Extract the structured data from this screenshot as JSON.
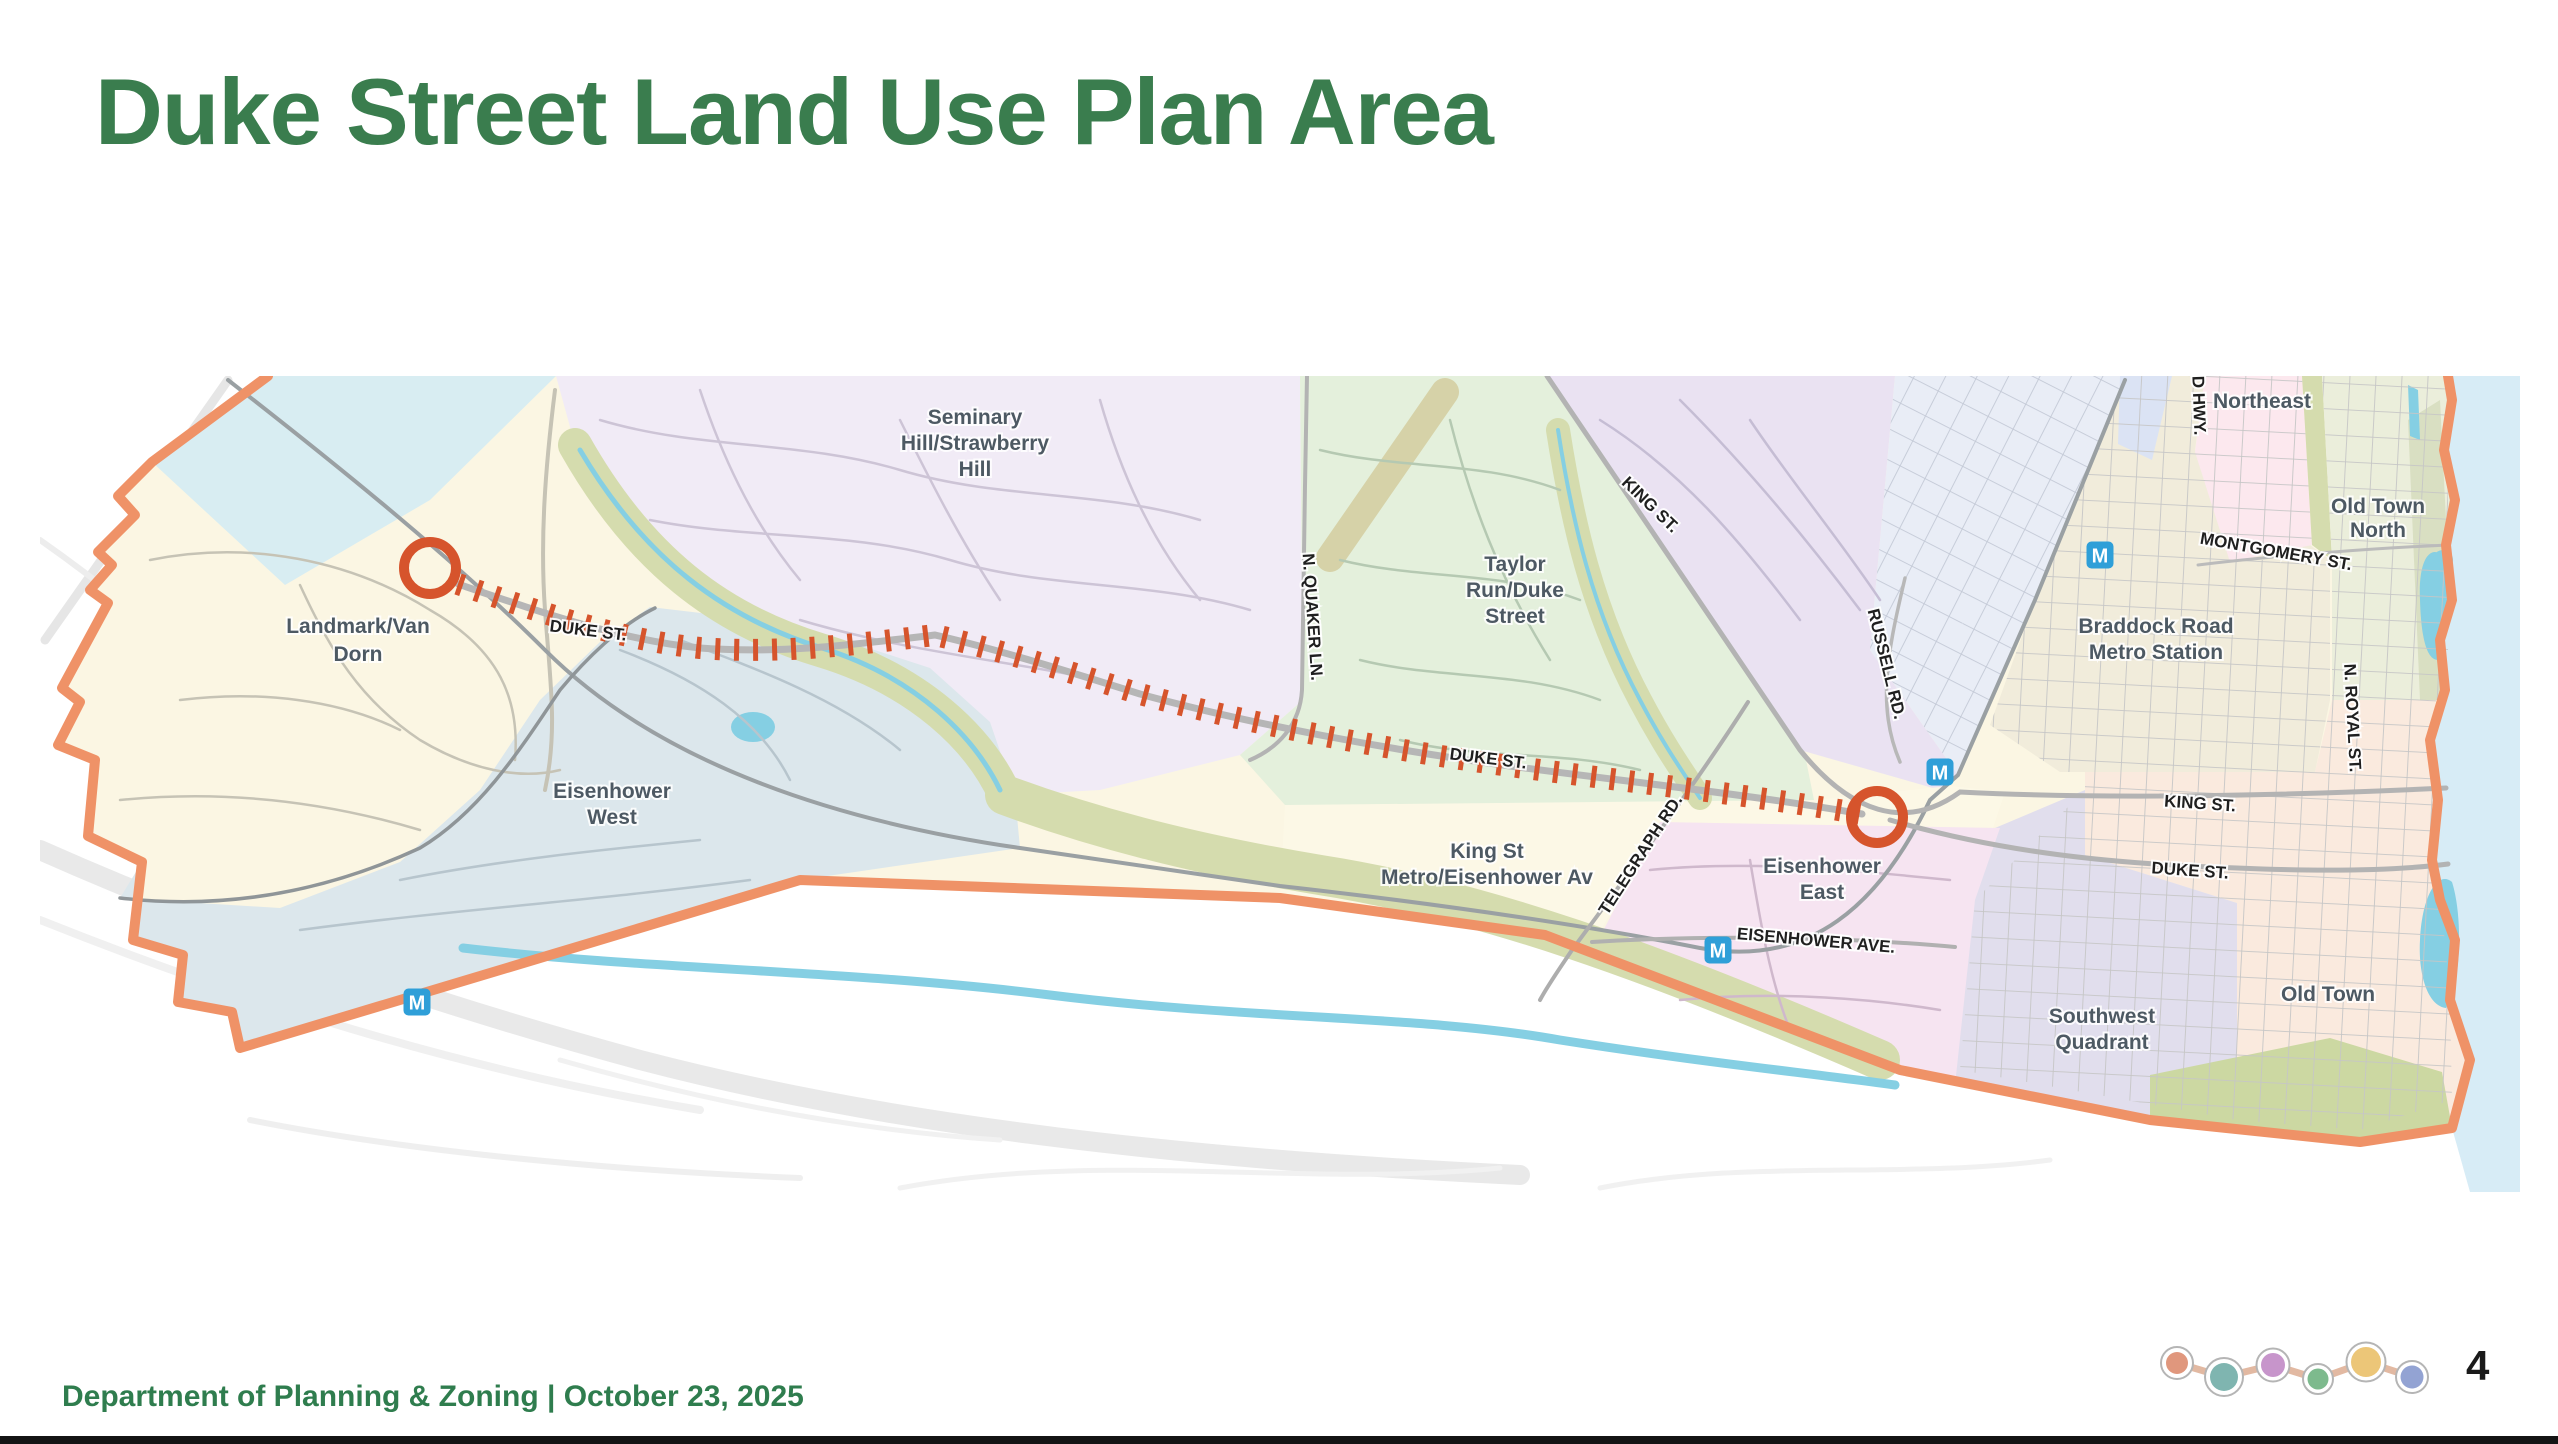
{
  "slide": {
    "title": "Duke Street Land Use Plan Area",
    "footer": "Department of Planning & Zoning  |  October 23, 2025",
    "page_number": "4"
  },
  "map": {
    "zone_labels": {
      "landmark_l1": "Landmark/Van",
      "landmark_l2": "Dorn",
      "eisenhower_west_l1": "Eisenhower",
      "eisenhower_west_l2": "West",
      "seminary_l1": "Seminary",
      "seminary_l2": "Hill/Strawberry",
      "seminary_l3": "Hill",
      "taylor_l1": "Taylor",
      "taylor_l2": "Run/Duke",
      "taylor_l3": "Street",
      "kingst_metro_l1": "King St",
      "kingst_metro_l2": "Metro/Eisenhower Av",
      "eisenhower_east_l1": "Eisenhower",
      "eisenhower_east_l2": "East",
      "braddock_l1": "Braddock Road",
      "braddock_l2": "Metro Station",
      "southwest_l1": "Southwest",
      "southwest_l2": "Quadrant",
      "old_town": "Old Town",
      "old_town_north_l1": "Old Town",
      "old_town_north_l2": "North",
      "northeast": "Northeast"
    },
    "street_labels": {
      "duke_west": "DUKE ST.",
      "duke_mid": "DUKE ST.",
      "duke_old_town": "DUKE ST.",
      "king_diag": "KING ST.",
      "king_old_town": "KING ST.",
      "quaker": "N. QUAKER LN.",
      "telegraph": "TELEGRAPH RD.",
      "russell": "RUSSELL RD.",
      "eisenhower_ave": "EISENHOWER AVE.",
      "montgomery": "MONTGOMERY ST.",
      "royal": "N. ROYAL ST.",
      "richmond": "RICHMOND HWY."
    },
    "metro_label": "M"
  },
  "nav": {
    "line_color": "#e2b9a2",
    "dot_colors": [
      "#e0977d",
      "#7fb5b0",
      "#c795cb",
      "#7dba8d",
      "#ecc678",
      "#93a3d3"
    ]
  },
  "colors": {
    "title_green": "#3a7d4e",
    "boundary_orange": "#ef9267",
    "corridor_red": "#d6542c",
    "metro_blue": "#2f9fd8",
    "water_blue": "#d7ecf6",
    "stream_cyan": "#85cfe3",
    "park_olive": "#d5dcae",
    "park_green": "#ccd8a2",
    "zone_west_blue": "#d8edf2",
    "zone_landmark": "#fbf6e3",
    "zone_seminary": "#f1ebf6",
    "zone_taylor": "#e4f0dc",
    "zone_upper_purple": "#eae2f2",
    "zone_delray": "#e9edf6",
    "zone_corridor_blue": "#dbe3f4",
    "zone_northeast": "#fce8ee",
    "zone_braddock": "#f1ecdb",
    "zone_old_town_north": "#ebeedb",
    "zone_old_town": "#faeade",
    "zone_southwest": "#e1deed",
    "zone_eisenhower_west": "#dce7ec",
    "zone_eisenhower_east": "#f6e4f1",
    "zone_kingst_metro": "#fcf8e6"
  }
}
